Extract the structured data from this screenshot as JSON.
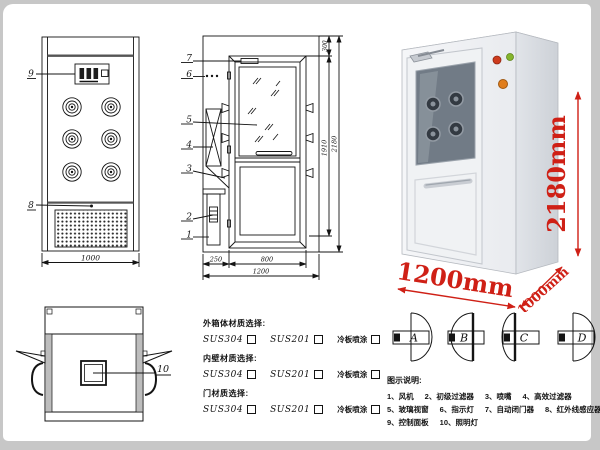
{
  "colors": {
    "line": "#141414",
    "accent_red": "#cf2016",
    "frame_bg": "#c7c7c7",
    "page_bg": "#ffffff"
  },
  "front_view": {
    "label_control_panel": "9",
    "label_grille": "8",
    "dim_width": "1000"
  },
  "side_view": {
    "labels": [
      "7",
      "6",
      "5",
      "4",
      "3",
      "2",
      "1"
    ],
    "dim_top": "300",
    "dim_inner_height": "1910",
    "dim_total_height": "2180",
    "dim_cabinet_depth": "250",
    "dim_door_width": "800",
    "dim_total_width": "1200"
  },
  "top_view": {
    "label_lamp": "10"
  },
  "photo": {
    "dim_height": "2180mm",
    "dim_width": "1200mm",
    "dim_depth": "1000mm"
  },
  "materials": {
    "sections": [
      {
        "title": "外箱体材质选择:",
        "options": [
          "SUS304",
          "SUS201",
          "冷板喷涂"
        ]
      },
      {
        "title": "内壁材质选择:",
        "options": [
          "SUS304",
          "SUS201",
          "冷板喷涂"
        ]
      },
      {
        "title": "门材质选择:",
        "options": [
          "SUS304",
          "SUS201",
          "冷板喷涂"
        ]
      }
    ]
  },
  "door_styles": [
    "A",
    "B",
    "C",
    "D"
  ],
  "legend": {
    "title": "图示说明:",
    "rows": [
      [
        "1、风机",
        "2、初级过滤器",
        "3、喷嘴",
        "4、高效过滤器"
      ],
      [
        "5、玻璃视窗",
        "6、指示灯",
        "7、自动闭门器",
        "8、红外线感应器"
      ],
      [
        "9、控制面板",
        "10、照明灯"
      ]
    ]
  }
}
